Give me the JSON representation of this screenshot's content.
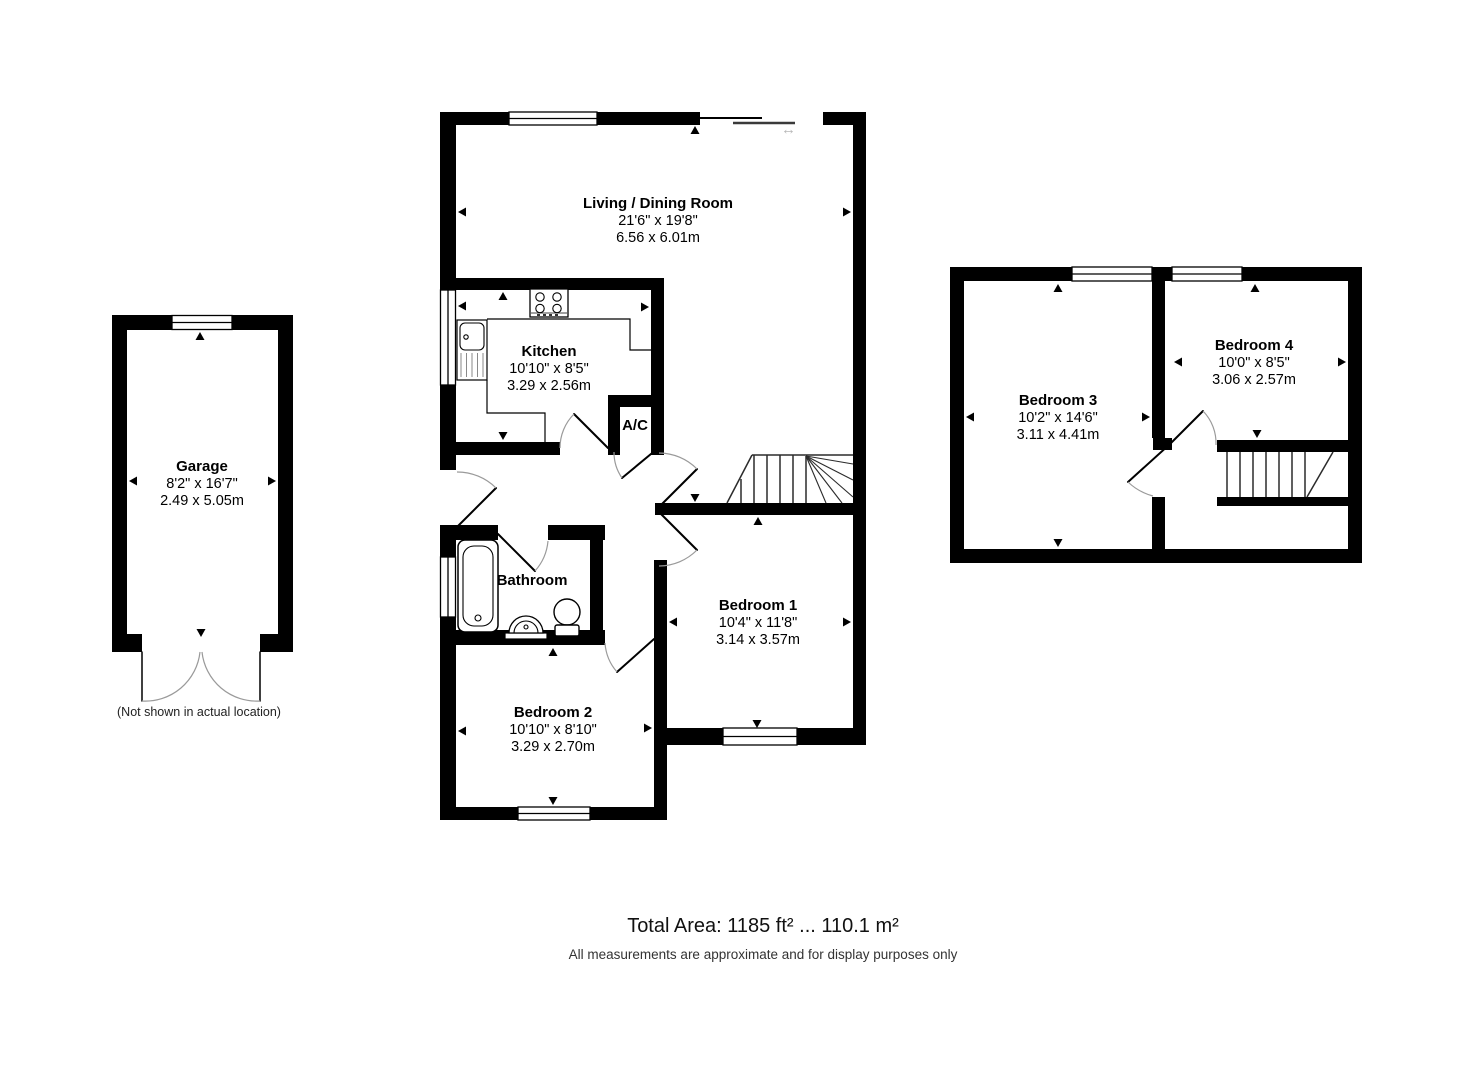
{
  "page": {
    "background": "#ffffff",
    "wall_color": "#000000",
    "door_arc_color": "#9a9a9a"
  },
  "rooms": {
    "living_dining": {
      "name": "Living / Dining Room",
      "imperial": "21'6\" x 19'8\"",
      "metric": "6.56 x 6.01m"
    },
    "kitchen": {
      "name": "Kitchen",
      "imperial": "10'10\" x 8'5\"",
      "metric": "3.29 x 2.56m"
    },
    "ac_closet": {
      "name": "A/C"
    },
    "bathroom": {
      "name": "Bathroom"
    },
    "bedroom1": {
      "name": "Bedroom 1",
      "imperial": "10'4\" x 11'8\"",
      "metric": "3.14 x 3.57m"
    },
    "bedroom2": {
      "name": "Bedroom 2",
      "imperial": "10'10\" x 8'10\"",
      "metric": "3.29 x 2.70m"
    },
    "garage": {
      "name": "Garage",
      "imperial": "8'2\" x 16'7\"",
      "metric": "2.49 x 5.05m",
      "note": "(Not shown in actual location)"
    },
    "bedroom3": {
      "name": "Bedroom 3",
      "imperial": "10'2\" x 14'6\"",
      "metric": "3.11 x 4.41m"
    },
    "bedroom4": {
      "name": "Bedroom 4",
      "imperial": "10'0\" x 8'5\"",
      "metric": "3.06 x 2.57m"
    }
  },
  "symbols": {
    "sliding_door_arrow": "↔"
  },
  "footer": {
    "total_area": "Total Area: 1185 ft² ... 110.1 m²",
    "disclaimer": "All measurements are approximate and for display purposes only"
  }
}
